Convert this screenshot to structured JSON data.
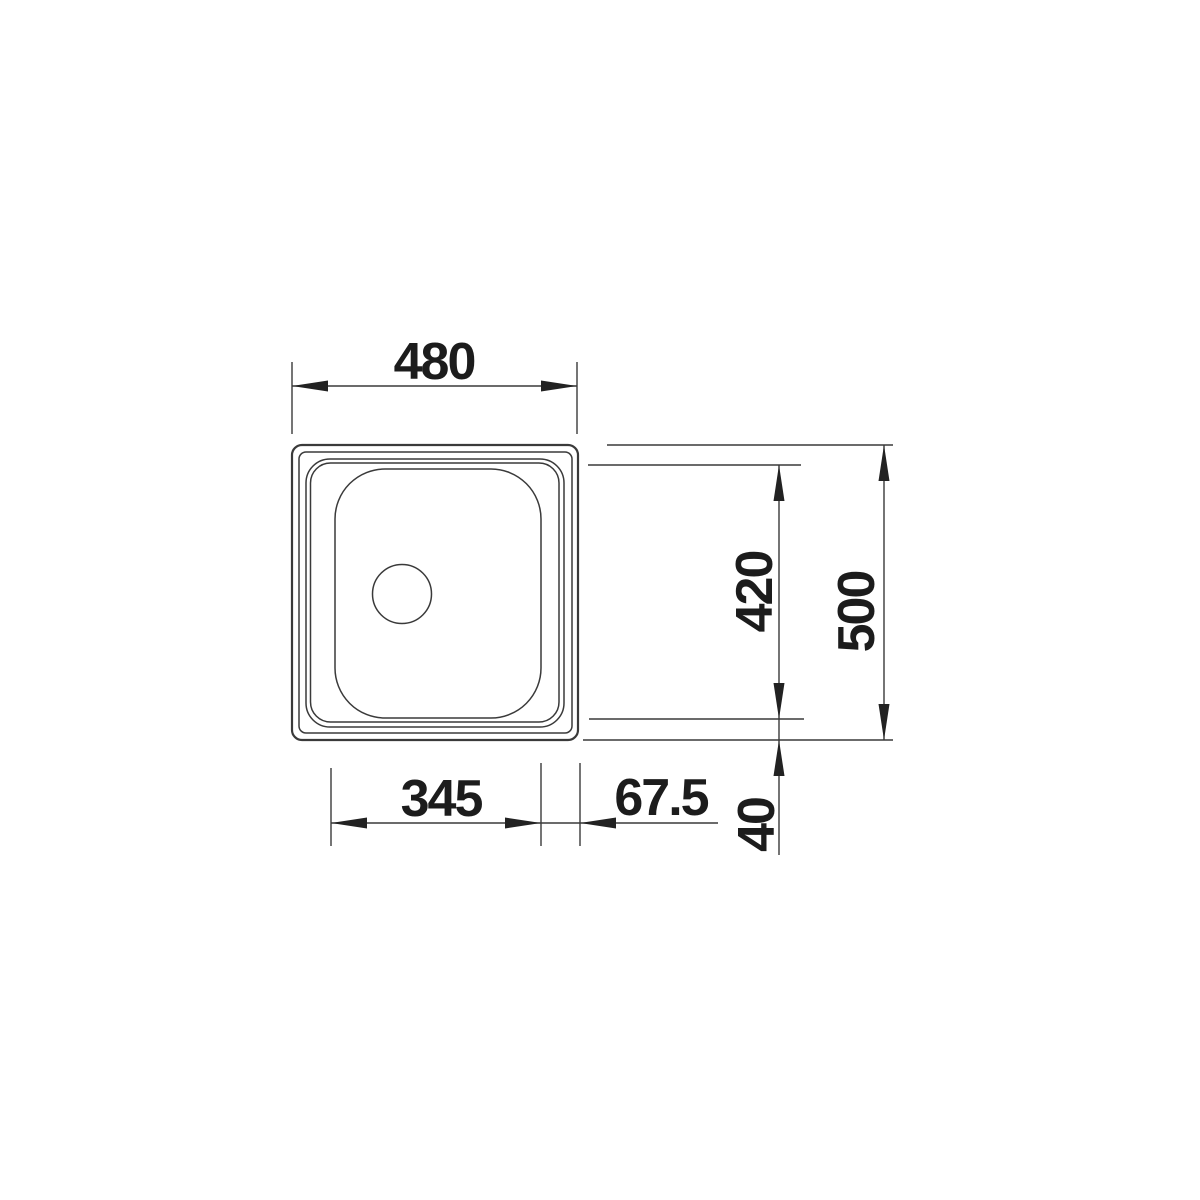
{
  "drawing": {
    "labels": {
      "width": "480",
      "bowl_depth": "420",
      "overall_depth": "500",
      "bowl_width": "345",
      "rim_offset_right": "67.5",
      "rim_offset_bottom": "40"
    },
    "colors": {
      "line": "#3a3a3a",
      "arrow": "#222222",
      "text": "#1c1c1c",
      "background": "#ffffff"
    }
  }
}
